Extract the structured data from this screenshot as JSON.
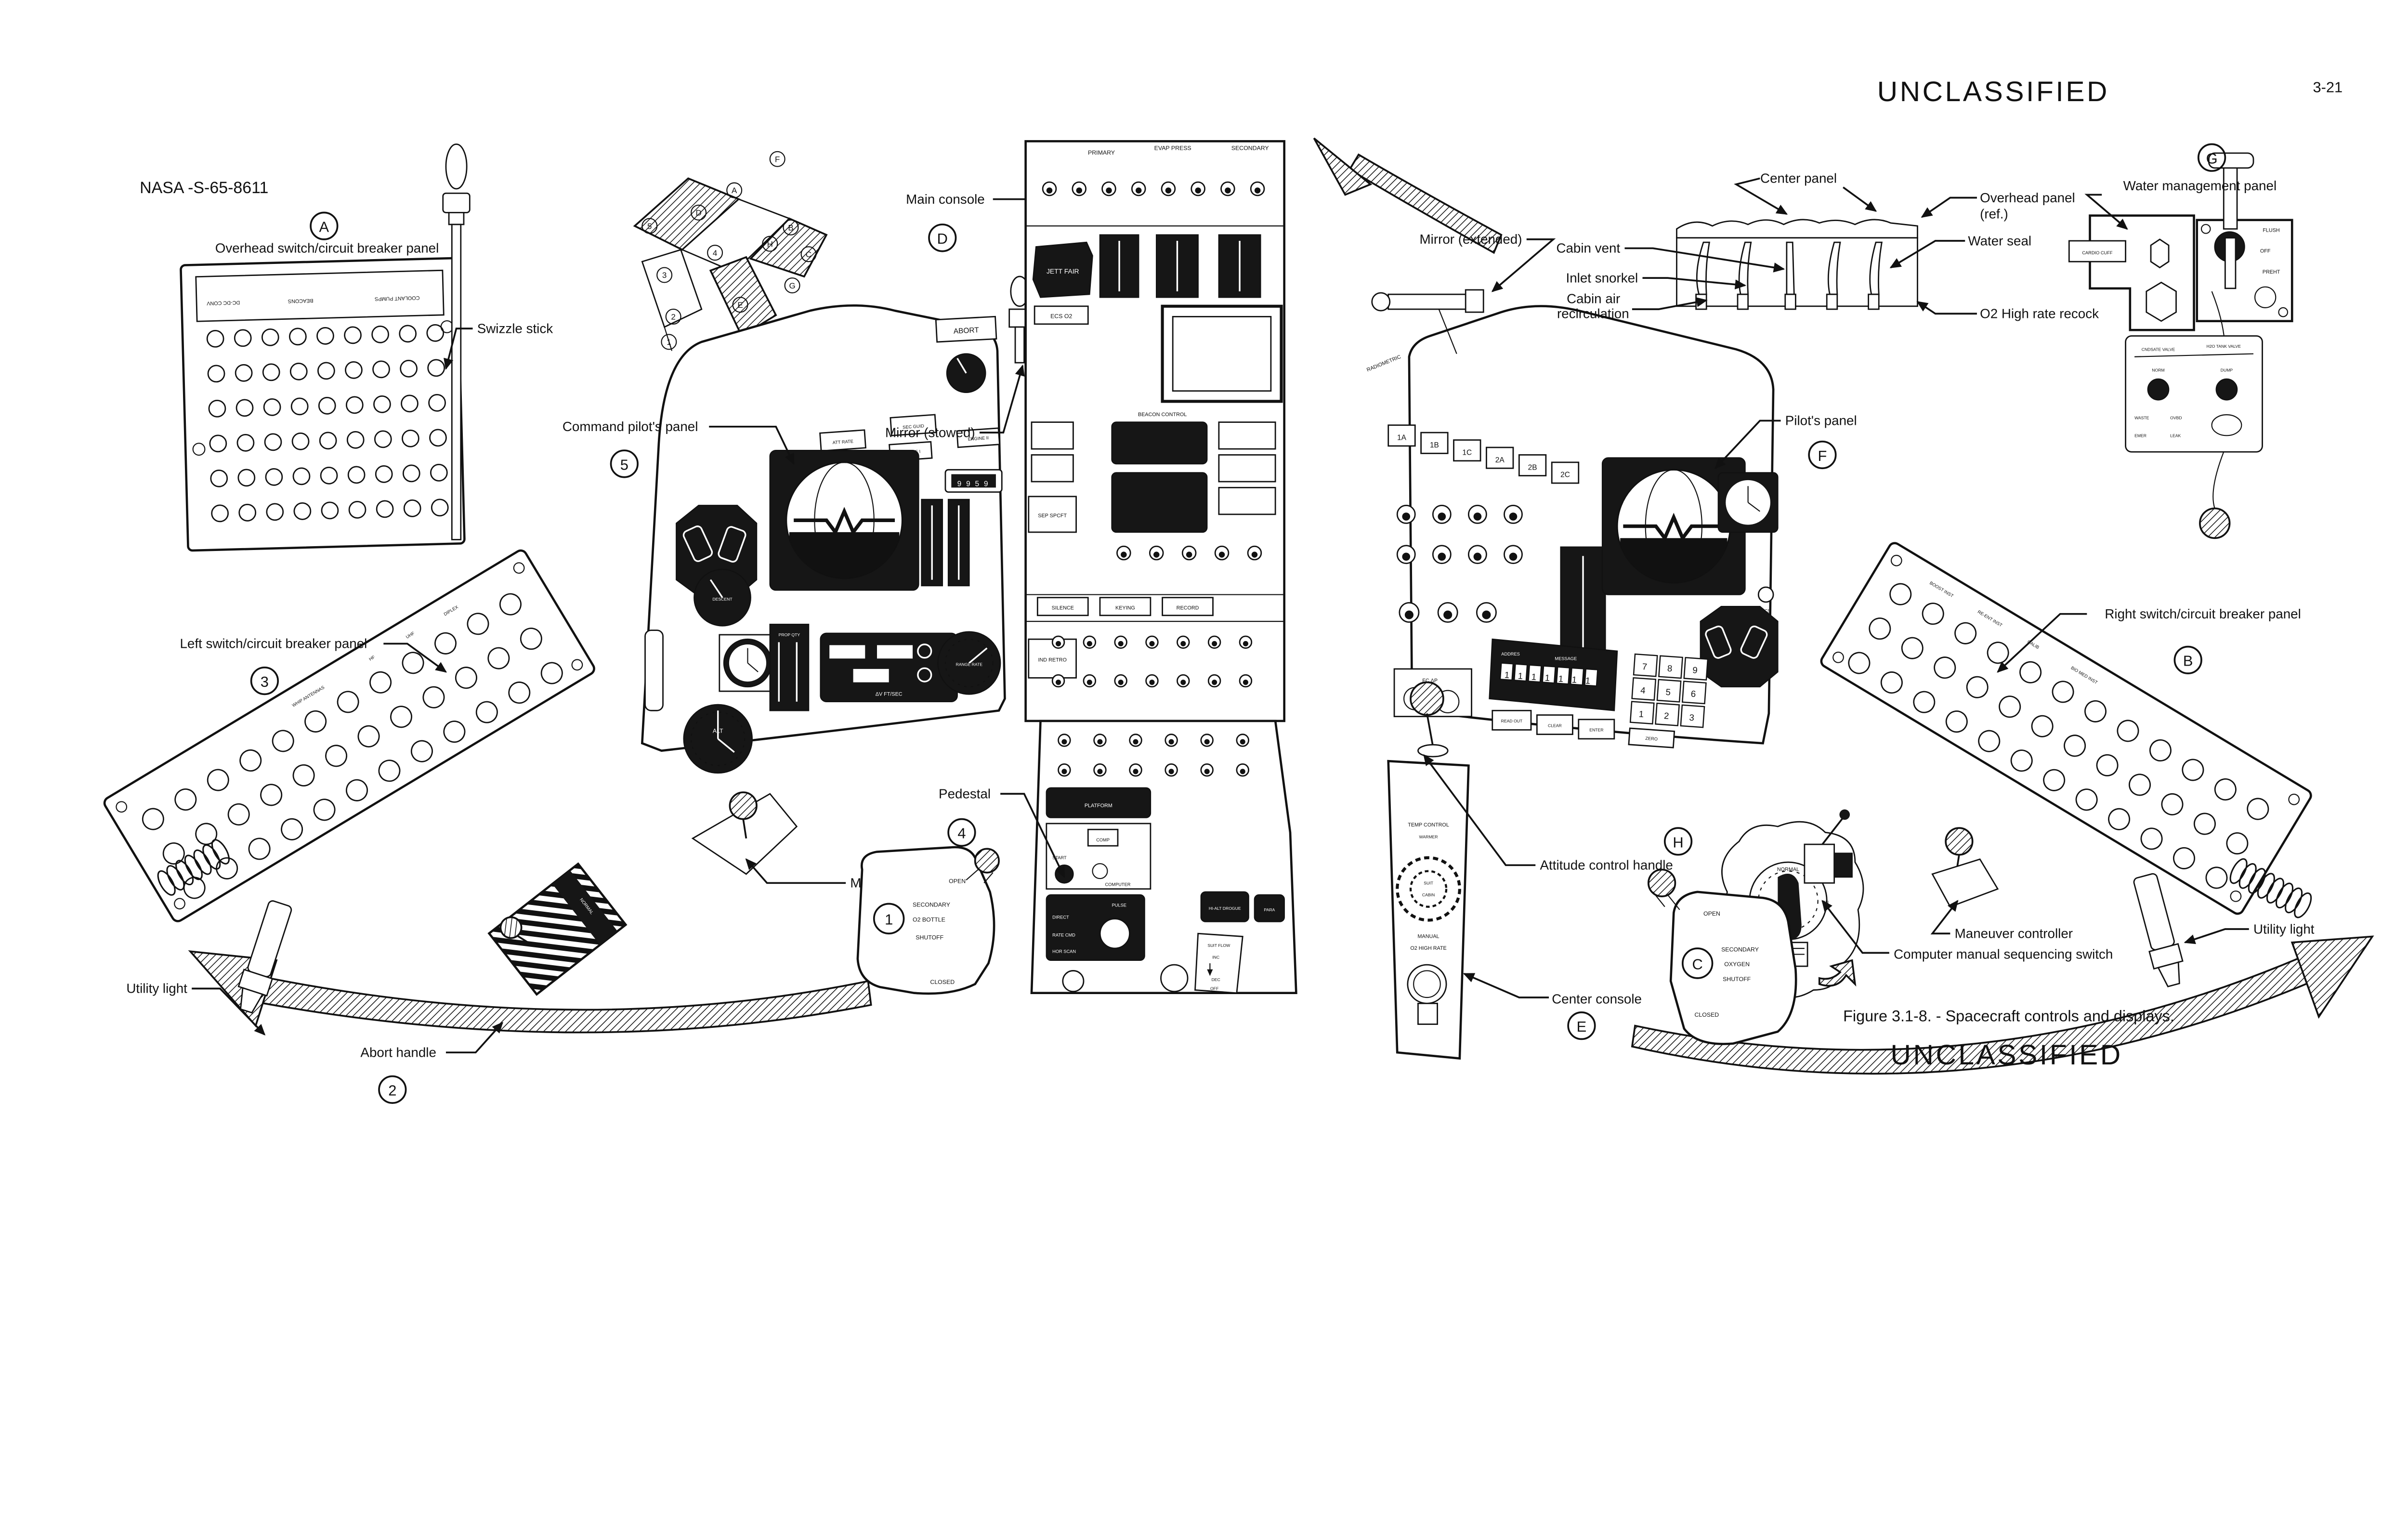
{
  "header": {
    "doc_number": "NASA -S-65-8611",
    "classification_top": "UNCLASSIFIED",
    "page_number": "3-21"
  },
  "footer": {
    "caption": "Figure 3.1-8. - Spacecraft controls and displays.",
    "classification_bottom": "UNCLASSIFIED"
  },
  "callouts": {
    "overhead_panel": {
      "ref": "A",
      "label": "Overhead switch/circuit breaker panel"
    },
    "swizzle_stick": {
      "label": "Swizzle stick"
    },
    "main_console": {
      "ref": "D",
      "label": "Main console"
    },
    "mirror_stowed": {
      "label": "Mirror (stowed)"
    },
    "command_pilots_panel": {
      "ref": "5",
      "label": "Command pilot's panel"
    },
    "mirror_extended": {
      "label": "Mirror (extended)"
    },
    "center_panel": {
      "label": "Center panel"
    },
    "overhead_panel_ref": {
      "line1": "Overhead panel",
      "line2": "(ref.)"
    },
    "water_seal": {
      "label": "Water seal"
    },
    "cabin_vent": {
      "label": "Cabin vent"
    },
    "inlet_snorkel": {
      "label": "Inlet snorkel"
    },
    "cabin_air_recirculation": {
      "line1": "Cabin air",
      "line2": "recirculation"
    },
    "o2_high_rate_recock": {
      "label": "O2 High rate recock"
    },
    "water_management_panel": {
      "ref": "G",
      "label": "Water management panel"
    },
    "pilots_panel": {
      "ref": "F",
      "label": "Pilot's panel"
    },
    "left_cb_panel": {
      "ref": "3",
      "label": "Left switch/circuit breaker panel"
    },
    "right_cb_panel": {
      "ref": "B",
      "label": "Right switch/circuit breaker panel"
    },
    "pedestal": {
      "ref": "4",
      "label": "Pedestal"
    },
    "maneuver_controller_left": {
      "label": "Maneuver controller"
    },
    "utility_light_left": {
      "label": "Utility light"
    },
    "abort_handle": {
      "ref": "2",
      "label": "Abort handle"
    },
    "attitude_control_handle": {
      "ref": "H",
      "label": "Attitude control handle"
    },
    "center_console": {
      "ref": "E",
      "label": "Center console"
    },
    "maneuver_controller_right": {
      "label": "Maneuver controller"
    },
    "computer_manual_sequencing_switch": {
      "label": "Computer manual sequencing switch"
    },
    "utility_light_right": {
      "label": "Utility light"
    }
  },
  "inset": {
    "refs": [
      "F",
      "A",
      "D",
      "5",
      "B",
      "H",
      "C",
      "4",
      "3",
      "G",
      "E",
      "2",
      "1"
    ]
  },
  "valves": {
    "secondary_o2_bottle": {
      "ref": "1",
      "lines": [
        "SECONDARY",
        "O2 BOTTLE",
        "SHUTOFF"
      ],
      "open": "OPEN",
      "closed": "CLOSED"
    },
    "secondary_oxygen": {
      "ref": "C",
      "lines": [
        "SECONDARY",
        "OXYGEN",
        "SHUTOFF"
      ],
      "open": "OPEN",
      "closed": "CLOSED"
    }
  },
  "panels": {
    "overhead": {
      "markings": [
        "COOLANT PUMPS",
        "BEACONS",
        "DC-DC CONV"
      ]
    },
    "main_console": {
      "markings": [
        "PRIMARY",
        "EVAP PRESS",
        "SECONDARY",
        "JETT FAIR",
        "ECS O2",
        "SEP SPCFT",
        "IND RETRO",
        "BEACON CONTROL",
        "SILENCE",
        "KEYING",
        "RECORD"
      ]
    },
    "command": {
      "markings": [
        "ABORT",
        "ATT RATE",
        "SEC GUID",
        "ENGINE I",
        "ENGINE II",
        "DESCENT",
        "ALT",
        "PROP QTY",
        "ΔV FT/SEC",
        "RANGE RATE"
      ],
      "timer": "9959"
    },
    "pilot": {
      "markings": [
        "1A",
        "1B",
        "1C",
        "2A",
        "2B",
        "2C",
        "AMMETER",
        "RADIOMETRIC",
        "ADDRES",
        "MESSAGE",
        "READ OUT",
        "CLEAR",
        "ENTER",
        "ZERO",
        "FC ΔP",
        "DCS"
      ],
      "keypad": [
        "7",
        "8",
        "9",
        "4",
        "5",
        "6",
        "1",
        "2",
        "3"
      ],
      "readout": "1111111"
    },
    "pedestal": {
      "markings": [
        "PLATFORM",
        "COMP",
        "START",
        "COMPUTER",
        "PULSE",
        "DIRECT",
        "RATE CMD",
        "HOR SCAN",
        "ATTITUDE CONTROL",
        "HI-ALT DROGUE",
        "PARA",
        "SUIT FLOW",
        "INC",
        "DEC",
        "OFF"
      ]
    },
    "center_console": {
      "markings": [
        "TEMP CONTROL",
        "WARMER",
        "SUIT",
        "CABIN",
        "MANUAL",
        "O2 HIGH RATE"
      ]
    },
    "water": {
      "markings": [
        "CARDIO CUFF",
        "FLUSH",
        "OFF",
        "PREHT",
        "CNDSATE VALVE",
        "H2O TANK VALVE",
        "NORM",
        "DUMP",
        "WASTE",
        "OVBD",
        "EMER",
        "LEAK"
      ]
    },
    "attitude_detail": {
      "markings": [
        "NORMAL",
        "OFF",
        "ON"
      ]
    },
    "abort_handle": {
      "marking": "NORMAL"
    },
    "left_cb": {
      "markings": [
        "WHIP ANTENNAS",
        "HF",
        "UHF",
        "DIPLEX"
      ]
    },
    "right_cb": {
      "markings": [
        "BOOST INST",
        "RE-ENT INST",
        "CALIB",
        "BIO MED INST"
      ]
    }
  }
}
